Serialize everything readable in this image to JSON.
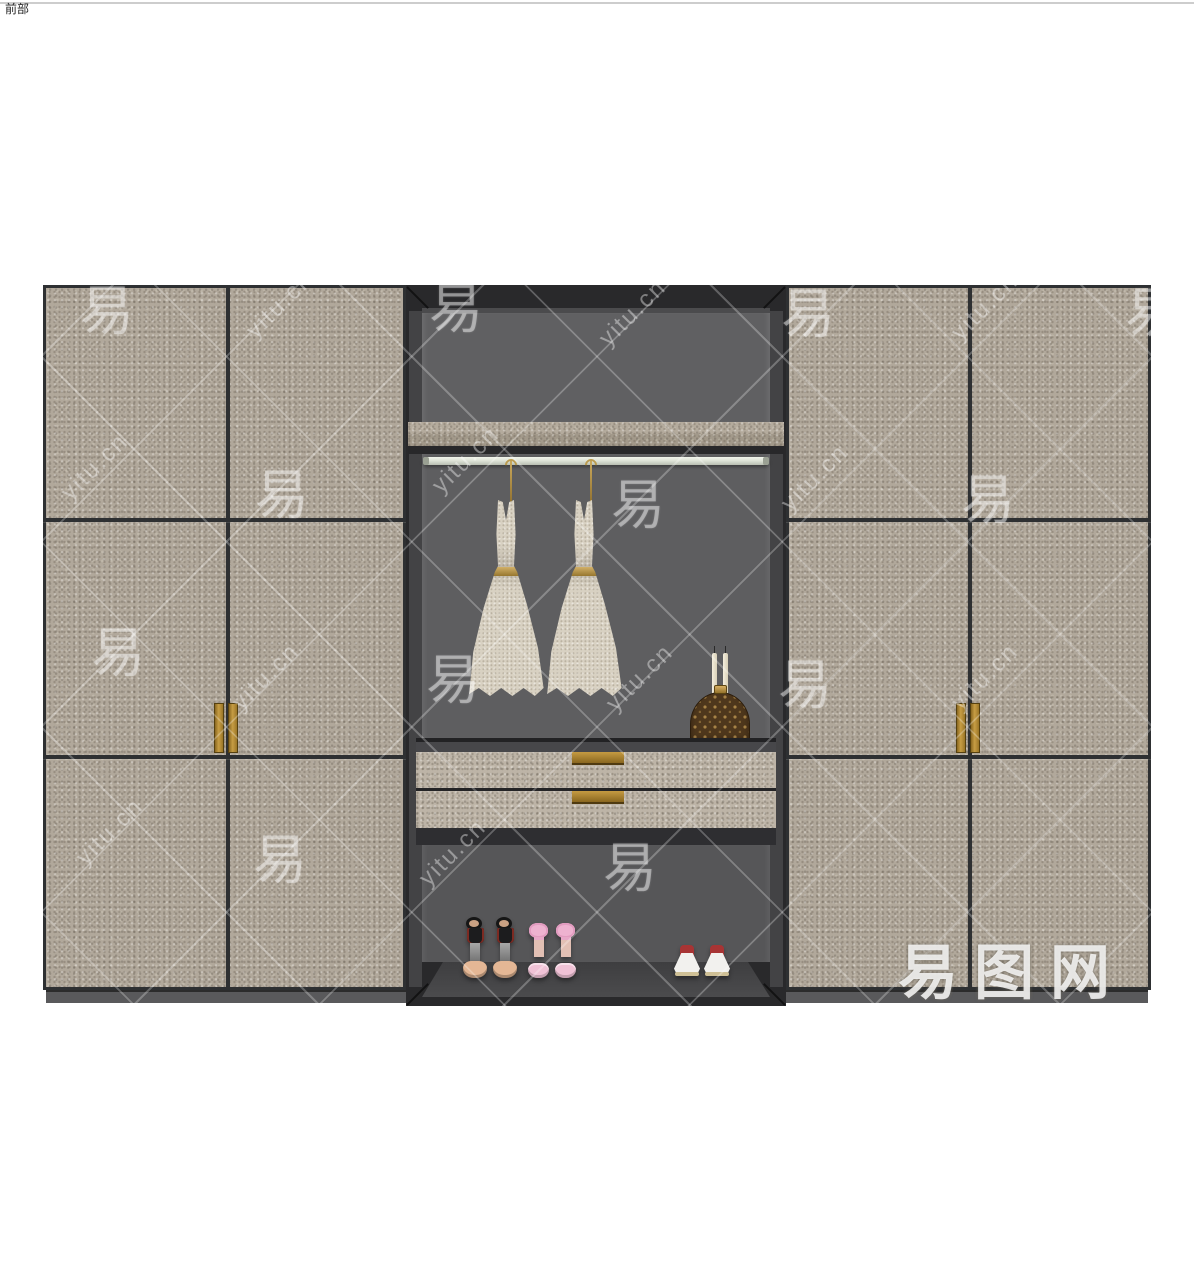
{
  "scene": {
    "label": "前部"
  },
  "watermark": {
    "text": "yitu.cn",
    "glyph": "易",
    "logo": "易图网",
    "tiles": [
      {
        "type": "glyph",
        "x": 107,
        "y": 306
      },
      {
        "type": "text",
        "x": 280,
        "y": 305
      },
      {
        "type": "glyph",
        "x": 456,
        "y": 304
      },
      {
        "type": "text",
        "x": 633,
        "y": 313
      },
      {
        "type": "glyph",
        "x": 808,
        "y": 309
      },
      {
        "type": "text",
        "x": 985,
        "y": 307
      },
      {
        "type": "glyph",
        "x": 1152,
        "y": 308
      },
      {
        "type": "text",
        "x": 95,
        "y": 467
      },
      {
        "type": "glyph",
        "x": 282,
        "y": 490
      },
      {
        "type": "text",
        "x": 466,
        "y": 460
      },
      {
        "type": "glyph",
        "x": 638,
        "y": 500
      },
      {
        "type": "text",
        "x": 815,
        "y": 478
      },
      {
        "type": "glyph",
        "x": 988,
        "y": 495
      },
      {
        "type": "glyph",
        "x": 118,
        "y": 648
      },
      {
        "type": "text",
        "x": 266,
        "y": 677
      },
      {
        "type": "glyph",
        "x": 453,
        "y": 675
      },
      {
        "type": "text",
        "x": 640,
        "y": 678
      },
      {
        "type": "glyph",
        "x": 805,
        "y": 680
      },
      {
        "type": "text",
        "x": 985,
        "y": 677
      },
      {
        "type": "text",
        "x": 110,
        "y": 832
      },
      {
        "type": "glyph",
        "x": 280,
        "y": 855
      },
      {
        "type": "text",
        "x": 453,
        "y": 853
      },
      {
        "type": "glyph",
        "x": 630,
        "y": 863
      }
    ]
  },
  "colors": {
    "door-stone": "#b1a89b",
    "drawer-stone": "#bdb4a7",
    "panel-line": "#2e3032",
    "frame": "#29292b",
    "interior": "#5e5e60",
    "base": "#59595b",
    "gold": "#b08a33",
    "rod": "#dfe4d8",
    "dress": "#d8d1c2",
    "bag": "#4e371c",
    "bag-pattern": "#c79d55"
  }
}
